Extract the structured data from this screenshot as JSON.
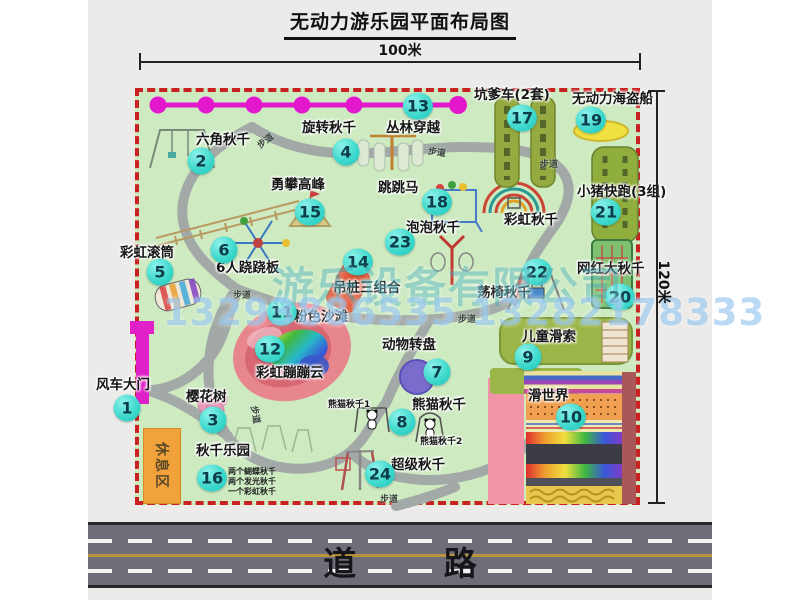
{
  "title": "无动力游乐园平面布局图",
  "dimensions": {
    "width_label": "100米",
    "height_label": "120米"
  },
  "road": {
    "label": "道 路"
  },
  "watermark": {
    "company": "游乐设备有限公司",
    "phone": "13293886535 13282178333"
  },
  "map": {
    "rest_area_label": "休息区",
    "path_label": "步道",
    "facilities": [
      {
        "num": "1",
        "label": "风车大门"
      },
      {
        "num": "2",
        "label": "六角秋千"
      },
      {
        "num": "3",
        "label": "樱花树"
      },
      {
        "num": "4",
        "label": "旋转秋千"
      },
      {
        "num": "5",
        "label": "彩虹滚筒"
      },
      {
        "num": "6",
        "label": "6人跷跷板"
      },
      {
        "num": "7",
        "label": "动物转盘"
      },
      {
        "num": "8",
        "label": "熊猫秋千"
      },
      {
        "num": "9",
        "label": "儿童滑索"
      },
      {
        "num": "10",
        "label": "滑世界"
      },
      {
        "num": "11",
        "label": "粉色沙滩"
      },
      {
        "num": "12",
        "label": "彩虹蹦蹦云"
      },
      {
        "num": "13",
        "label": "丛林穿越"
      },
      {
        "num": "14",
        "label": "吊桩三组合"
      },
      {
        "num": "15",
        "label": "勇攀高峰"
      },
      {
        "num": "16",
        "label": "秋千乐园"
      },
      {
        "num": "17",
        "label": "坑爹车(2套)"
      },
      {
        "num": "18",
        "label": "跳跳马"
      },
      {
        "num": "19",
        "label": "无动力海盗船"
      },
      {
        "num": "20",
        "label": "网红大秋千"
      },
      {
        "num": "21",
        "label": "小猪快跑(3组)"
      },
      {
        "num": "22",
        "label": "荡椅秋千"
      },
      {
        "num": "23",
        "label": "泡泡秋千"
      },
      {
        "num": "24",
        "label": "超级秋千"
      }
    ],
    "extra": {
      "rainbow_swing": "彩虹秋千",
      "panda_swing_1": "熊猫秋千1",
      "panda_swing_2": "熊猫秋千2",
      "swing_park_note_1": "两个蝴蝶秋千",
      "swing_park_note_2": "两个发光秋千",
      "swing_park_note_3": "一个彩虹秋千"
    }
  },
  "colors": {
    "map_green": "#cdeac1",
    "border_red": "#c92121",
    "bubble_teal": "#3fd9cd",
    "zipline_magenta": "#e318cc",
    "road_gray": "#6e6e78",
    "rest_orange": "#f2a23a"
  }
}
